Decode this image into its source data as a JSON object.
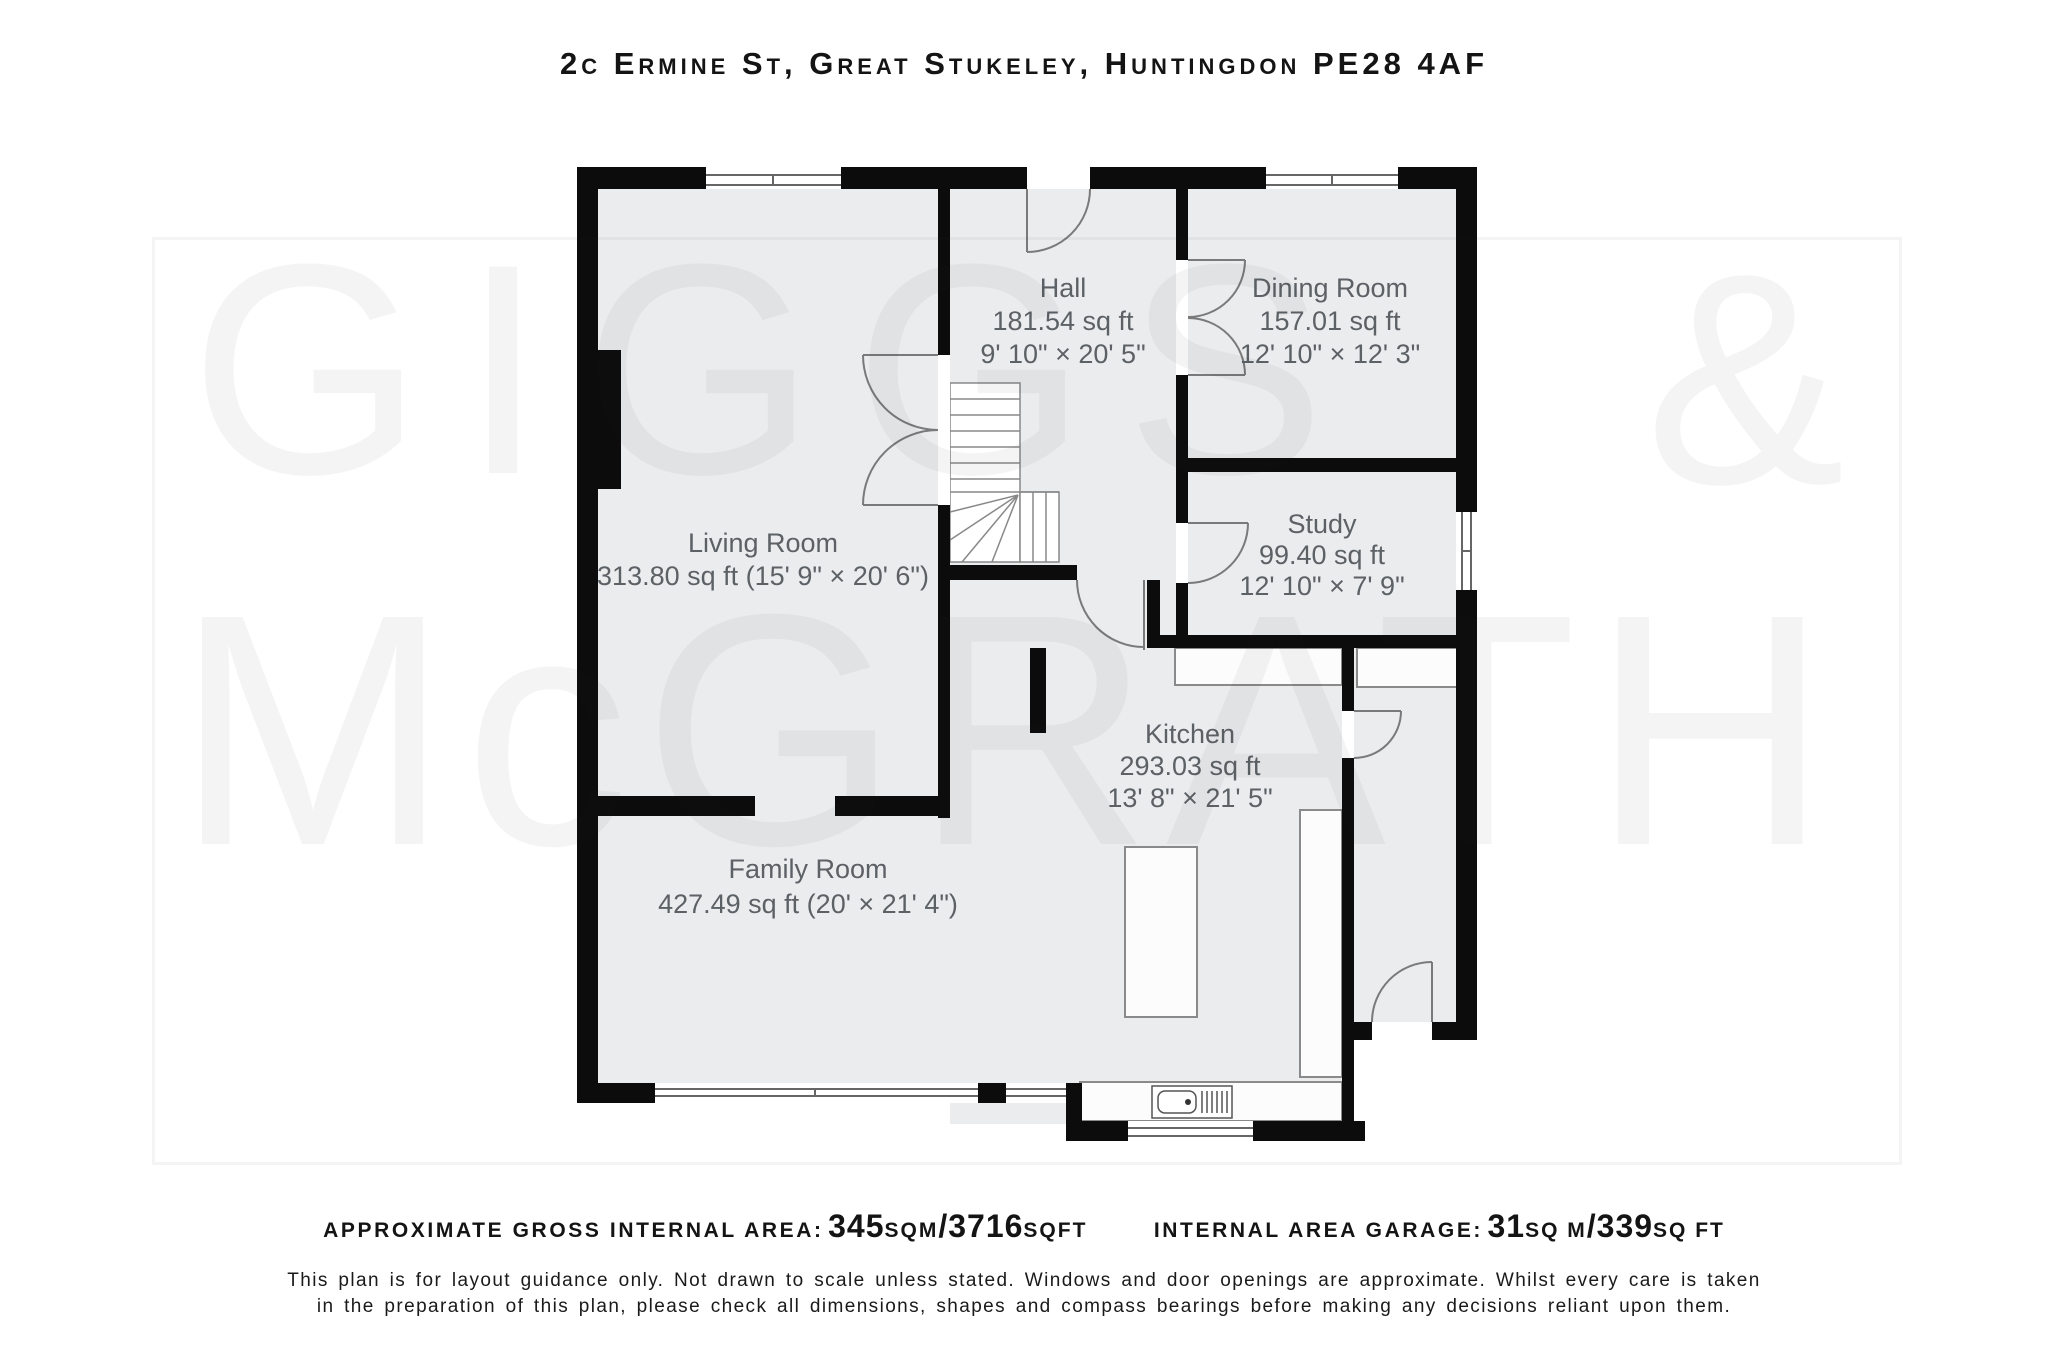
{
  "title": "2c Ermine St, Great Stukeley, Huntingdon PE28 4AF",
  "watermark": {
    "word1": "GIGGS",
    "amp": "&",
    "word2": "McGRATH"
  },
  "rooms": {
    "hall": {
      "name": "Hall",
      "area": "181.54 sq ft",
      "dims": "9' 10\" × 20' 5\""
    },
    "dining": {
      "name": "Dining Room",
      "area": "157.01 sq ft",
      "dims": "12' 10\" × 12' 3\""
    },
    "living": {
      "name": "Living Room",
      "area_dims": "313.80 sq ft (15' 9\" × 20' 6\")"
    },
    "study": {
      "name": "Study",
      "area": "99.40 sq ft",
      "dims": "12' 10\" × 7' 9\""
    },
    "kitchen": {
      "name": "Kitchen",
      "area": "293.03 sq ft",
      "dims": "13' 8\" × 21' 5\""
    },
    "family": {
      "name": "Family Room",
      "area_dims": "427.49 sq ft (20' × 21' 4\")"
    }
  },
  "footer": {
    "gross_label": "Approximate gross internal area:",
    "gross_value1": "345",
    "gross_unit1": "sqm",
    "gross_slash": "/",
    "gross_value2": "3716",
    "gross_unit2": "sqft",
    "garage_label": "Internal area garage:",
    "garage_value1": "31",
    "garage_unit1": "sq m",
    "garage_slash": "/",
    "garage_value2": "339",
    "garage_unit2": "sq ft",
    "disclaimer_line1": "This plan is for layout guidance only. Not drawn to scale unless stated. Windows and door openings are approximate. Whilst every care is taken",
    "disclaimer_line2": "in the preparation of this plan, please check all dimensions, shapes and compass bearings before making any decisions reliant upon them."
  },
  "colors": {
    "wall": "#0c0c0c",
    "floor": "#ebecee",
    "fixture_line": "#7a7a7a",
    "label_text": "#5c6166",
    "watermark": "rgba(30,30,30,0.05)"
  }
}
